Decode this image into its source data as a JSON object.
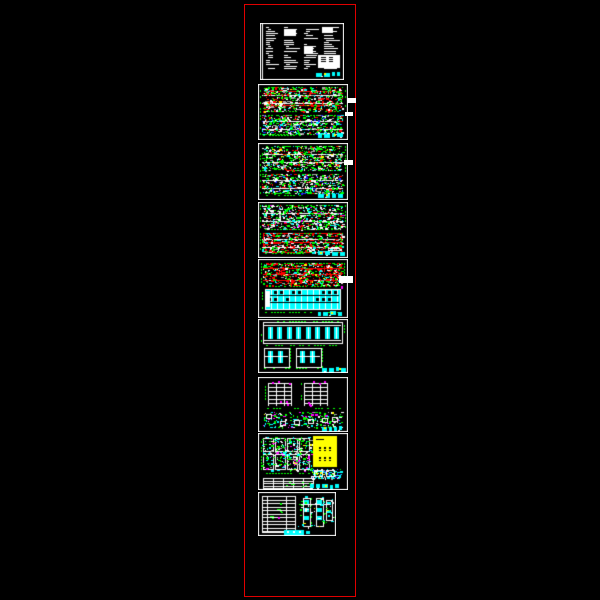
{
  "viewer": {
    "background_color": "#000000",
    "frame_color": "#e00000",
    "description": "CAD drawing set preview: vertical stack of nine architectural sheets inside a red plot boundary on a black model-space canvas"
  },
  "palette": {
    "red": "#ff0000",
    "green": "#00ff00",
    "cyan": "#00ffff",
    "blue": "#2222ff",
    "magenta": "#ff00ff",
    "yellow": "#ffff00",
    "white": "#ffffff",
    "gray": "#a8a8a8",
    "black": "#000000"
  },
  "sheets": [
    {
      "name": "general-notes",
      "type": "notes",
      "variant": "",
      "label": "General notes and specification text sheet with title block"
    },
    {
      "name": "floor-plan-1",
      "type": "plan",
      "variant": "red-top",
      "label": "Floor plan sheet, two plan strips with red walls and green dimensions"
    },
    {
      "name": "floor-plan-2",
      "type": "plan",
      "variant": "balanced",
      "label": "Floor plan sheet, two plan strips with green dimensions"
    },
    {
      "name": "floor-plan-3",
      "type": "plan",
      "variant": "red-bottom",
      "label": "Floor plan sheet, lower strip outlined in red"
    },
    {
      "name": "roof-plan-front-elevation",
      "type": "roof-elevation",
      "variant": "",
      "label": "Red roof framing plan above cyan front elevation"
    },
    {
      "name": "rear-side-elevations",
      "type": "elevations",
      "variant": "",
      "label": "Rear elevation with cyan windows and two side elevations"
    },
    {
      "name": "sections-stair-details",
      "type": "sections",
      "variant": "",
      "label": "Two building sections with stair details below"
    },
    {
      "name": "unit-plans-schedule",
      "type": "details-yellow",
      "variant": "",
      "label": "Unit plan details with yellow highlighted schedule block"
    },
    {
      "name": "tables-details",
      "type": "table-details",
      "variant": "",
      "label": "Door-window table with vertical detail drawings"
    }
  ],
  "annotations": {
    "leader_callout_count": 4,
    "title_strip_colors": [
      "#00ffff",
      "#ffff00",
      "#ffffff"
    ]
  }
}
